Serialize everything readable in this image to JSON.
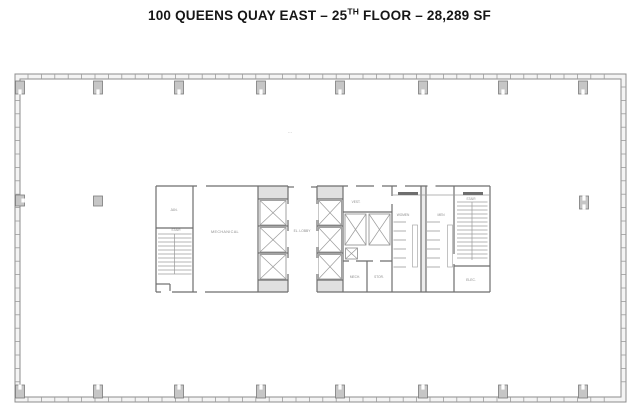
{
  "title": {
    "line_start": "100 QUEENS QUAY EAST – 25",
    "ordinal_suffix": "TH",
    "line_end": " FLOOR – 28,289 SF"
  },
  "floor_plan": {
    "labels": {
      "janitor": "JAN.",
      "stair_left": "STAIR",
      "mechanical": "MECHANICAL",
      "elevator_lobby": "EL. LOBBY",
      "vestibule": "VEST.",
      "mech_small": "MECH.",
      "storage": "STOR.",
      "women": "WOMEN",
      "men": "MEN",
      "stair_right": "STAIR",
      "electrical": "ELEC.",
      "floor_note": "···"
    },
    "colors": {
      "perimeter_line": "#8d8d8d",
      "core_wall": "#6e6e6e",
      "detail_line": "#9b9b9b",
      "column_fill": "#c6c6c6",
      "elevator_cap_fill": "#e0e0e0",
      "label_text": "#8c8c8c",
      "title_text": "#161616"
    }
  }
}
